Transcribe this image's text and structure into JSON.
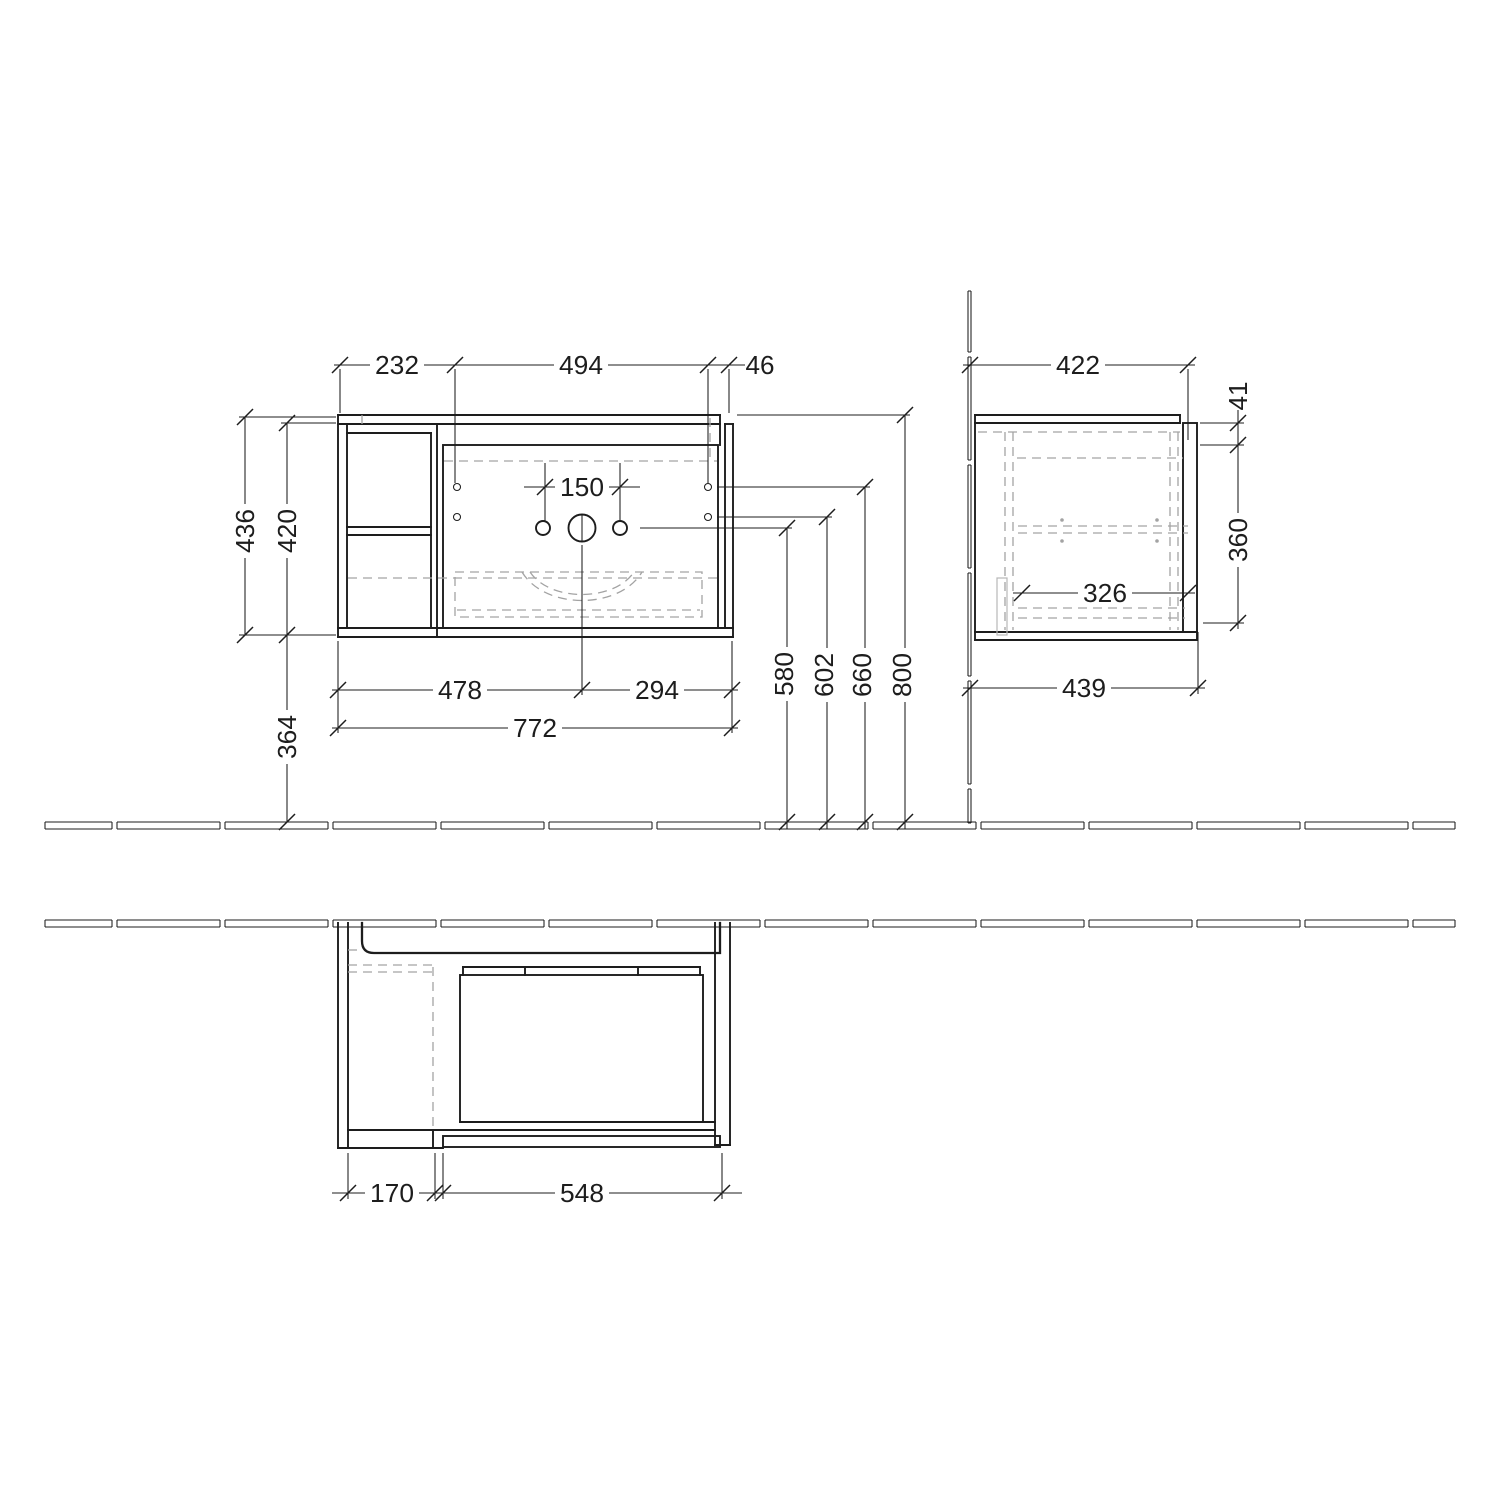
{
  "drawing_title": "vanity-unit-dimension-drawing",
  "colors": {
    "background": "#ffffff",
    "line": "#1d1d1d",
    "hidden_line": "#a3a3a3"
  },
  "front_view": {
    "top_widths": [
      "232",
      "494",
      "46"
    ],
    "left_heights": [
      "436",
      "420"
    ],
    "height_below": "364",
    "tap_hole_spacing": "150",
    "bottom_widths": [
      "478",
      "294"
    ],
    "total_width": "772",
    "mount_heights": [
      "580",
      "602",
      "660",
      "800"
    ]
  },
  "side_view": {
    "top_depth": "422",
    "top_edge": "41",
    "front_height": "360",
    "inner_depth": "326",
    "bottom_depth": "439"
  },
  "plan_view": {
    "left_depth": "170",
    "basin_width": "548"
  }
}
